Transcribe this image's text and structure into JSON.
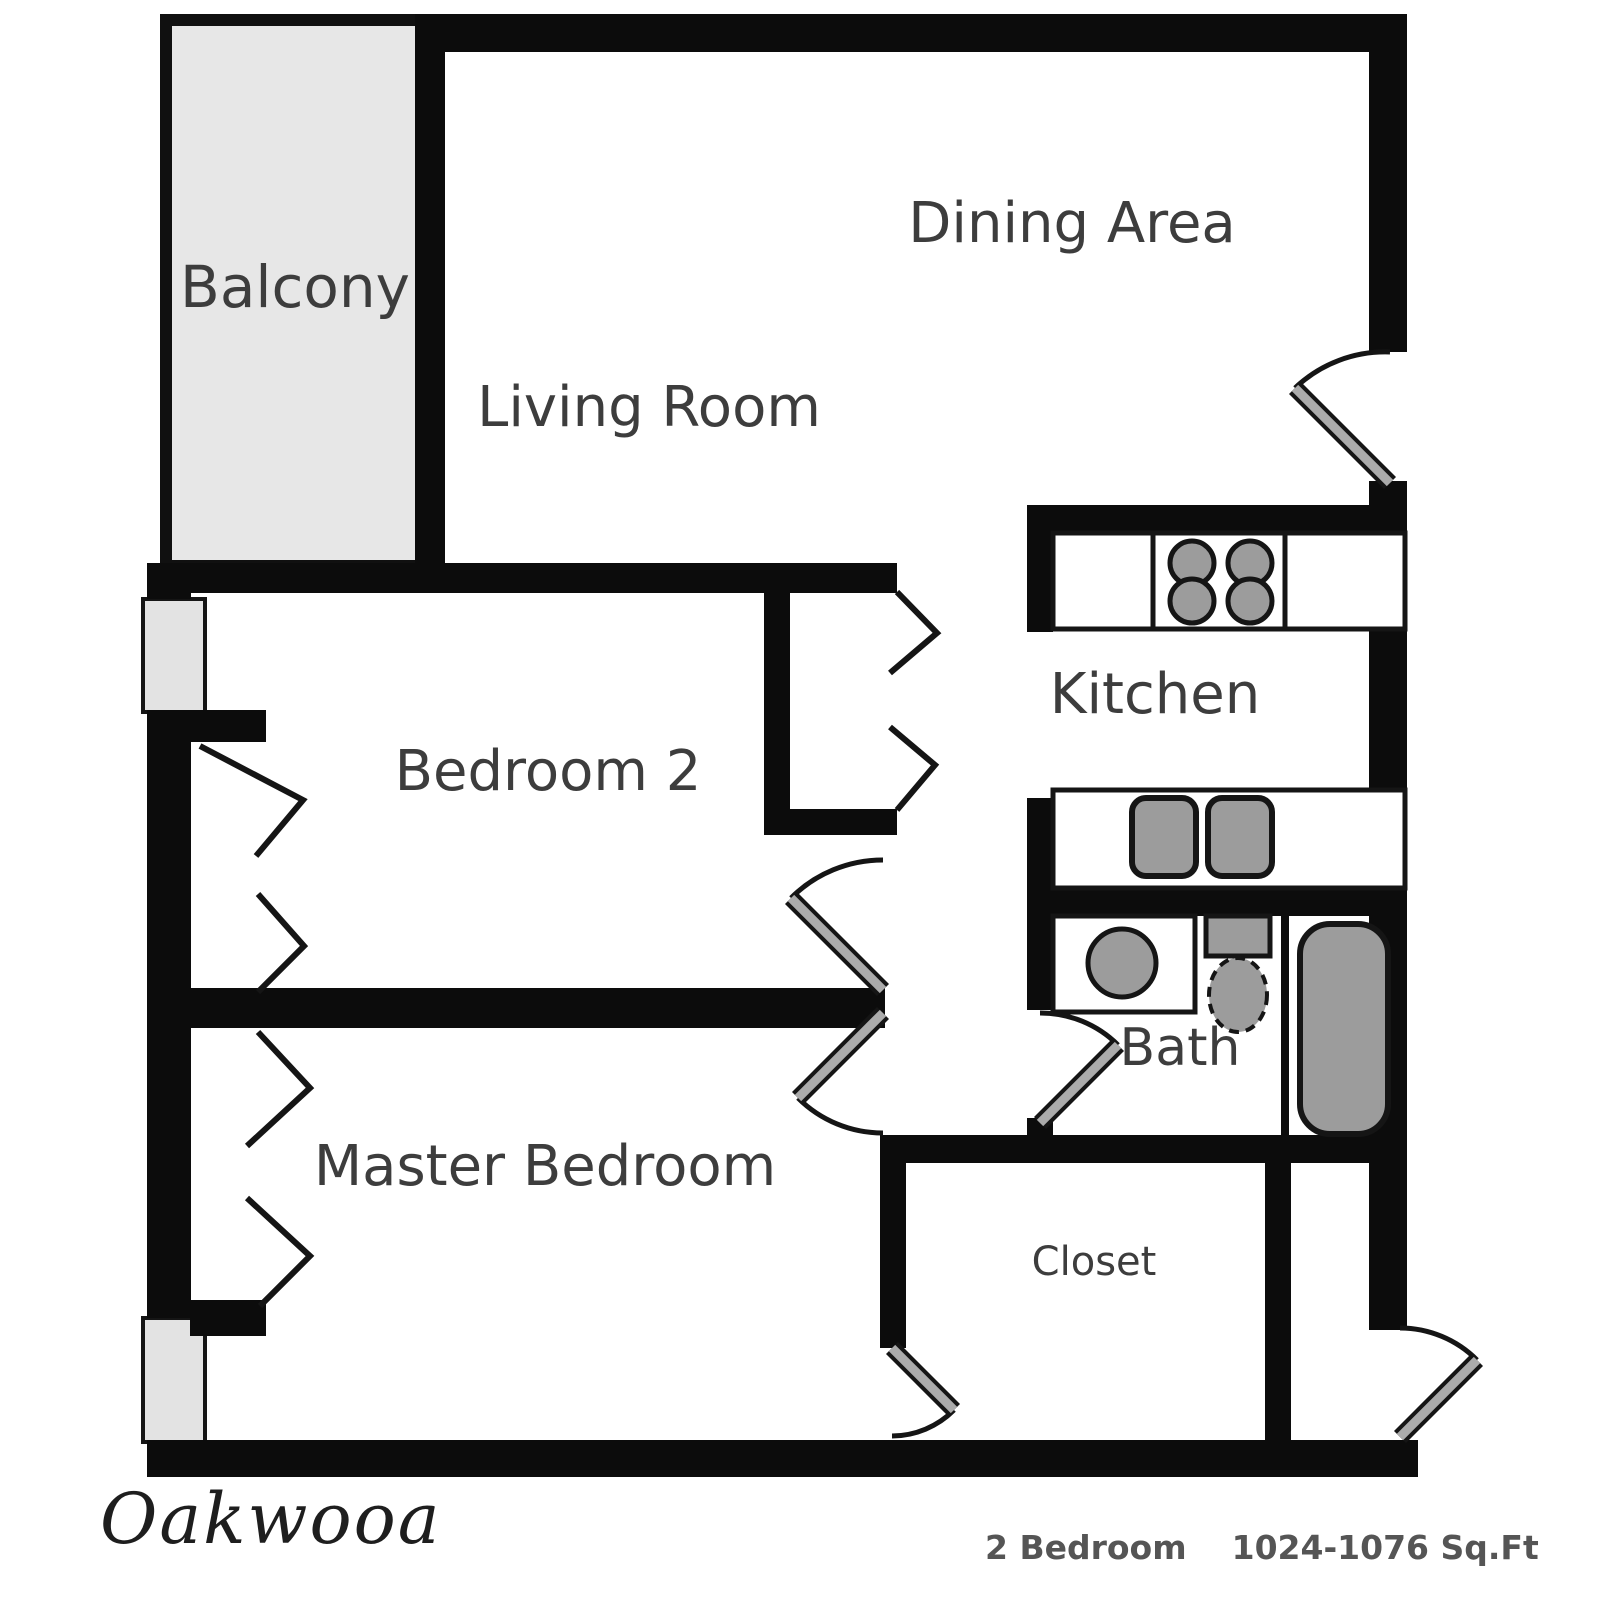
{
  "rooms": {
    "balcony": "Balcony",
    "dining_area": "Dining Area",
    "living_room": "Living Room",
    "bedroom_2": "Bedroom 2",
    "kitchen": "Kitchen",
    "bath": "Bath",
    "master_bedroom": "Master Bedroom",
    "closet": "Closet"
  },
  "footer": {
    "logo": "Oakwooa",
    "unit_type": "2 Bedroom",
    "area": "1024-1076 Sq.Ft"
  },
  "colors": {
    "wall": "#0c0c0c",
    "balcony_fill": "#e7e7e7",
    "window_fill": "#e3e3e3",
    "fixture_gray": "#9c9c9c",
    "door_leaf_gray": "#ababab",
    "label_text": "#3d3d3d",
    "footer_text": "#555555",
    "background": "#ffffff"
  },
  "icons": {
    "stove": "stove-4-burner-icon",
    "kitchen_sink": "double-sink-icon",
    "vanity_sink": "round-sink-icon",
    "toilet": "toilet-icon",
    "bathtub": "bathtub-icon",
    "window": "window-block-icon",
    "bifold": "bifold-closet-door-icon",
    "door": "door-swing-icon"
  }
}
